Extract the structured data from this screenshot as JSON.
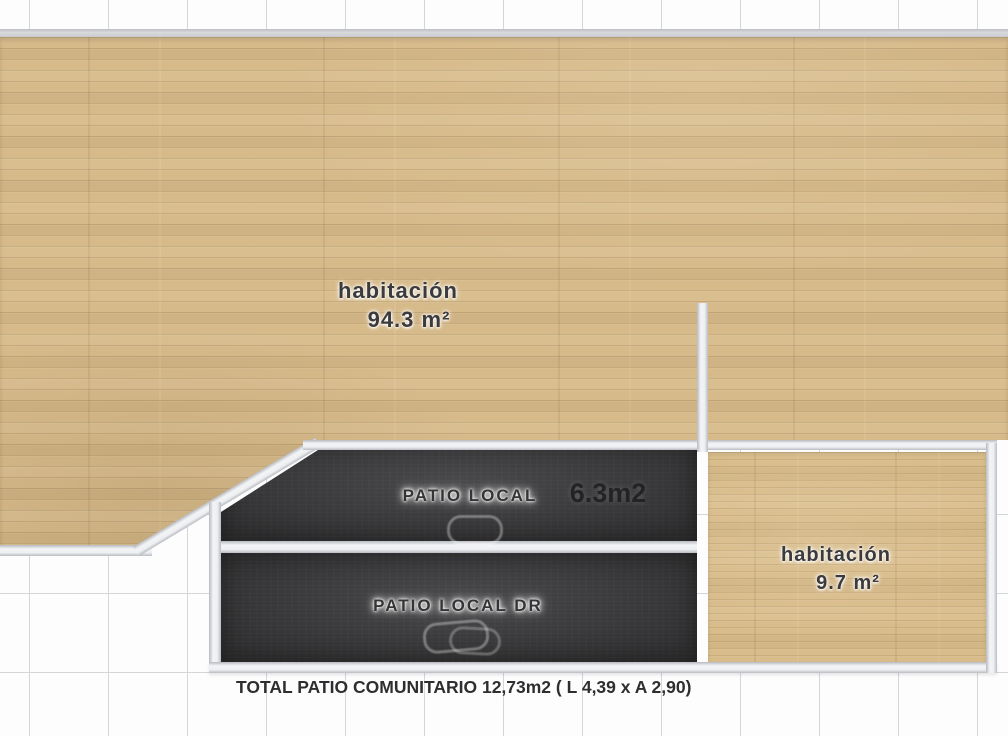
{
  "rooms": {
    "main": {
      "name": "habitación",
      "area": "94.3 m²"
    },
    "patio_local": {
      "name": "PATIO LOCAL",
      "area": "6.3m2"
    },
    "patio_dr": {
      "name": "PATIO LOCAL DR"
    },
    "small": {
      "name": "habitación",
      "area": "9.7 m²"
    }
  },
  "footer": {
    "total": "TOTAL PATIO COMUNITARIO 12,73m2 ( L 4,39 x A 2,90)"
  },
  "colors": {
    "wood": "#d6ba8a",
    "patio_dark": "#3d3d3f",
    "wall": "#eef0f2",
    "grid_line": "#d5d6d9",
    "text_dark": "#3b3b3d"
  }
}
